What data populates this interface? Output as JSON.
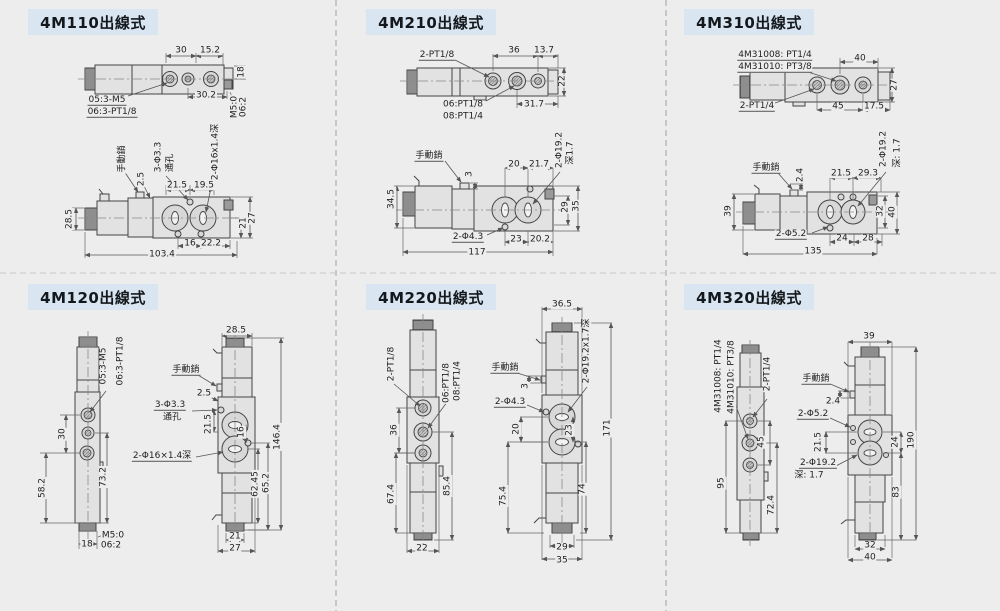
{
  "page": {
    "background": "#ededed",
    "badge_bg": "#d9e6f2",
    "line_color": "#444444"
  },
  "panels": [
    {
      "id": "4M110",
      "title": "4M110出線式",
      "labels": [
        {
          "t": "30",
          "x": 181,
          "y": 51
        },
        {
          "t": "15.2",
          "x": 210,
          "y": 51
        },
        {
          "t": "18",
          "x": 242,
          "y": 72,
          "r": 1
        },
        {
          "t": "30.2",
          "x": 206,
          "y": 96
        },
        {
          "t": "M5:0",
          "x": 235,
          "y": 107,
          "r": 1
        },
        {
          "t": "06:2",
          "x": 244,
          "y": 107,
          "r": 1
        },
        {
          "t": "05:3-M5",
          "x": 107,
          "y": 101,
          "u": 1
        },
        {
          "t": "06:3-PT1/8",
          "x": 112,
          "y": 113,
          "u": 1
        },
        {
          "t": "手動銷",
          "x": 123,
          "y": 159,
          "r": 1
        },
        {
          "t": "2.5",
          "x": 142,
          "y": 179,
          "r": 1
        },
        {
          "t": "3-Φ3.3",
          "x": 159,
          "y": 157,
          "r": 1
        },
        {
          "t": "通孔",
          "x": 171,
          "y": 163,
          "r": 1
        },
        {
          "t": "21.5",
          "x": 177,
          "y": 186
        },
        {
          "t": "19.5",
          "x": 204,
          "y": 186
        },
        {
          "t": "2-Φ16x1.4深",
          "x": 216,
          "y": 152,
          "r": 1
        },
        {
          "t": "28.5",
          "x": 70,
          "y": 219,
          "r": 1
        },
        {
          "t": "21",
          "x": 244,
          "y": 223,
          "r": 1
        },
        {
          "t": "27",
          "x": 253,
          "y": 218,
          "r": 1
        },
        {
          "t": "16",
          "x": 190,
          "y": 244
        },
        {
          "t": "22.2",
          "x": 211,
          "y": 244
        },
        {
          "t": "103.4",
          "x": 162,
          "y": 255
        }
      ]
    },
    {
      "id": "4M210",
      "title": "4M210出線式",
      "labels": [
        {
          "t": "2-PT1/8",
          "x": 437,
          "y": 56,
          "u": 1
        },
        {
          "t": "36",
          "x": 514,
          "y": 51
        },
        {
          "t": "13.7",
          "x": 544,
          "y": 51
        },
        {
          "t": "22",
          "x": 563,
          "y": 81,
          "r": 1
        },
        {
          "t": "06:PT1/8",
          "x": 463,
          "y": 105
        },
        {
          "t": "08:PT1/4",
          "x": 463,
          "y": 117
        },
        {
          "t": "31.7",
          "x": 534,
          "y": 105
        },
        {
          "t": "手動銷",
          "x": 429,
          "y": 157,
          "u": 1
        },
        {
          "t": "3",
          "x": 470,
          "y": 174,
          "r": 1
        },
        {
          "t": "20",
          "x": 514,
          "y": 165
        },
        {
          "t": "21.7",
          "x": 539,
          "y": 165
        },
        {
          "t": "2-Φ19.2",
          "x": 560,
          "y": 150,
          "r": 1
        },
        {
          "t": "深1.7",
          "x": 571,
          "y": 153,
          "r": 1
        },
        {
          "t": "34.5",
          "x": 392,
          "y": 199,
          "r": 1
        },
        {
          "t": "29",
          "x": 566,
          "y": 207,
          "r": 1
        },
        {
          "t": "35",
          "x": 577,
          "y": 206,
          "r": 1
        },
        {
          "t": "2-Φ4.3",
          "x": 468,
          "y": 238,
          "u": 1
        },
        {
          "t": "23",
          "x": 516,
          "y": 240
        },
        {
          "t": "20.2",
          "x": 540,
          "y": 240
        },
        {
          "t": "117",
          "x": 477,
          "y": 253
        }
      ]
    },
    {
      "id": "4M310",
      "title": "4M310出線式",
      "labels": [
        {
          "t": "4M31008: PT1/4",
          "x": 775,
          "y": 56,
          "u": 1
        },
        {
          "t": "4M31010: PT3/8",
          "x": 775,
          "y": 68,
          "u": 1
        },
        {
          "t": "40",
          "x": 860,
          "y": 59
        },
        {
          "t": "27",
          "x": 895,
          "y": 85,
          "r": 1
        },
        {
          "t": "2-PT1/4",
          "x": 757,
          "y": 107,
          "u": 1
        },
        {
          "t": "45",
          "x": 838,
          "y": 107
        },
        {
          "t": "17.5",
          "x": 874,
          "y": 107
        },
        {
          "t": "手動銷",
          "x": 766,
          "y": 169,
          "u": 1
        },
        {
          "t": "2.4",
          "x": 801,
          "y": 175,
          "r": 1
        },
        {
          "t": "21.5",
          "x": 841,
          "y": 174
        },
        {
          "t": "29.3",
          "x": 868,
          "y": 174
        },
        {
          "t": "2-Φ19.2",
          "x": 884,
          "y": 149,
          "r": 1
        },
        {
          "t": "深: 1.7",
          "x": 898,
          "y": 153,
          "r": 1
        },
        {
          "t": "39",
          "x": 729,
          "y": 211,
          "r": 1
        },
        {
          "t": "32",
          "x": 881,
          "y": 211,
          "r": 1
        },
        {
          "t": "40",
          "x": 893,
          "y": 212,
          "r": 1
        },
        {
          "t": "2-Φ5.2",
          "x": 791,
          "y": 235,
          "u": 1
        },
        {
          "t": "24",
          "x": 842,
          "y": 239
        },
        {
          "t": "28",
          "x": 868,
          "y": 239
        },
        {
          "t": "135",
          "x": 813,
          "y": 252
        }
      ]
    },
    {
      "id": "4M120",
      "title": "4M120出線式",
      "labels": [
        {
          "t": "05:3-M5",
          "x": 104,
          "y": 366,
          "r": 1
        },
        {
          "t": "06:3-PT1/8",
          "x": 121,
          "y": 361,
          "r": 1
        },
        {
          "t": "30",
          "x": 63,
          "y": 434,
          "r": 1
        },
        {
          "t": "73.2",
          "x": 104,
          "y": 477,
          "r": 1
        },
        {
          "t": "58.2",
          "x": 43,
          "y": 488,
          "r": 1
        },
        {
          "t": "M5:0",
          "x": 113,
          "y": 536
        },
        {
          "t": "06:2",
          "x": 111,
          "y": 546
        },
        {
          "t": "18",
          "x": 87,
          "y": 545
        },
        {
          "t": "28.5",
          "x": 236,
          "y": 331
        },
        {
          "t": "手動銷",
          "x": 186,
          "y": 371,
          "u": 1
        },
        {
          "t": "2.5",
          "x": 204,
          "y": 394
        },
        {
          "t": "3-Φ3.3",
          "x": 170,
          "y": 406,
          "u": 1
        },
        {
          "t": "通孔",
          "x": 172,
          "y": 418
        },
        {
          "t": "21.5",
          "x": 209,
          "y": 424,
          "r": 1
        },
        {
          "t": "16",
          "x": 242,
          "y": 432,
          "r": 1
        },
        {
          "t": "2-Φ16×1.4深",
          "x": 162,
          "y": 457,
          "u": 1
        },
        {
          "t": "146.4",
          "x": 278,
          "y": 437,
          "r": 1
        },
        {
          "t": "62.45",
          "x": 256,
          "y": 484,
          "r": 1
        },
        {
          "t": "65.2",
          "x": 267,
          "y": 483,
          "r": 1
        },
        {
          "t": "21",
          "x": 235,
          "y": 537
        },
        {
          "t": "27",
          "x": 235,
          "y": 549
        }
      ]
    },
    {
      "id": "4M220",
      "title": "4M220出線式",
      "labels": [
        {
          "t": "2-PT1/8",
          "x": 392,
          "y": 364,
          "r": 1
        },
        {
          "t": "06:PT1/8",
          "x": 447,
          "y": 383,
          "r": 1
        },
        {
          "t": "08:PT1/4",
          "x": 458,
          "y": 381,
          "r": 1
        },
        {
          "t": "36",
          "x": 395,
          "y": 430,
          "r": 1
        },
        {
          "t": "67.4",
          "x": 392,
          "y": 494,
          "r": 1
        },
        {
          "t": "85.4",
          "x": 448,
          "y": 486,
          "r": 1
        },
        {
          "t": "22",
          "x": 422,
          "y": 549
        },
        {
          "t": "36.5",
          "x": 562,
          "y": 305
        },
        {
          "t": "手動銷",
          "x": 505,
          "y": 369,
          "u": 1
        },
        {
          "t": "3",
          "x": 526,
          "y": 386,
          "r": 1
        },
        {
          "t": "2-Φ4.3",
          "x": 510,
          "y": 403,
          "u": 1
        },
        {
          "t": "2-Φ19.2x1.7深",
          "x": 587,
          "y": 351,
          "r": 1
        },
        {
          "t": "20",
          "x": 517,
          "y": 429,
          "r": 1
        },
        {
          "t": "23",
          "x": 570,
          "y": 430,
          "r": 1
        },
        {
          "t": "171",
          "x": 608,
          "y": 428,
          "r": 1
        },
        {
          "t": "75.4",
          "x": 504,
          "y": 496,
          "r": 1
        },
        {
          "t": "74",
          "x": 583,
          "y": 489,
          "r": 1
        },
        {
          "t": "29",
          "x": 562,
          "y": 548
        },
        {
          "t": "35",
          "x": 562,
          "y": 561
        }
      ]
    },
    {
      "id": "4M320",
      "title": "4M320出線式",
      "labels": [
        {
          "t": "4M31008: PT1/4",
          "x": 719,
          "y": 376,
          "r": 1
        },
        {
          "t": "4M31010: PT3/8",
          "x": 732,
          "y": 377,
          "r": 1
        },
        {
          "t": "2-PT1/4",
          "x": 768,
          "y": 374,
          "r": 1
        },
        {
          "t": "45",
          "x": 762,
          "y": 442,
          "r": 1
        },
        {
          "t": "95",
          "x": 722,
          "y": 483,
          "r": 1
        },
        {
          "t": "72.4",
          "x": 772,
          "y": 505,
          "r": 1
        },
        {
          "t": "39",
          "x": 869,
          "y": 337
        },
        {
          "t": "手動銷",
          "x": 816,
          "y": 380,
          "u": 1
        },
        {
          "t": "2.4",
          "x": 833,
          "y": 402
        },
        {
          "t": "2-Φ5.2",
          "x": 813,
          "y": 415,
          "u": 1
        },
        {
          "t": "21.5",
          "x": 819,
          "y": 442,
          "r": 1
        },
        {
          "t": "2-Φ19.2",
          "x": 818,
          "y": 464,
          "u": 1
        },
        {
          "t": "深: 1.7",
          "x": 809,
          "y": 476
        },
        {
          "t": "24",
          "x": 896,
          "y": 442,
          "r": 1
        },
        {
          "t": "190",
          "x": 912,
          "y": 440,
          "r": 1
        },
        {
          "t": "83",
          "x": 897,
          "y": 492,
          "r": 1
        },
        {
          "t": "32",
          "x": 870,
          "y": 546
        },
        {
          "t": "40",
          "x": 870,
          "y": 558
        }
      ]
    }
  ]
}
